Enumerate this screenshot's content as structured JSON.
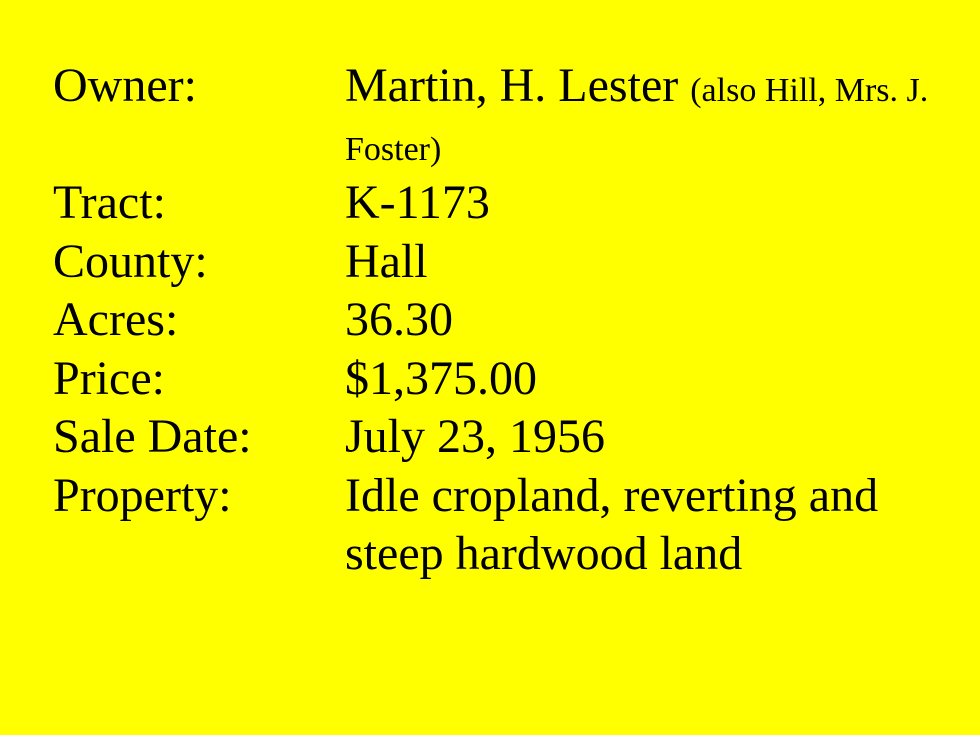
{
  "slide": {
    "background_color": "#FFFF00",
    "text_color": "#000000",
    "record": {
      "rows": [
        {
          "label": "Owner:",
          "value": "Martin, H. Lester",
          "note": "(also Hill, Mrs. J. Foster)"
        },
        {
          "label": "Tract:",
          "value": "K-1173"
        },
        {
          "label": "County:",
          "value": "Hall"
        },
        {
          "label": "Acres:",
          "value": "36.30"
        },
        {
          "label": "Price:",
          "value": "$1,375.00"
        },
        {
          "label": "Sale Date:",
          "value": "July 23, 1956"
        },
        {
          "label": "Property:",
          "value": "Idle cropland, reverting and steep hardwood land"
        }
      ]
    }
  }
}
